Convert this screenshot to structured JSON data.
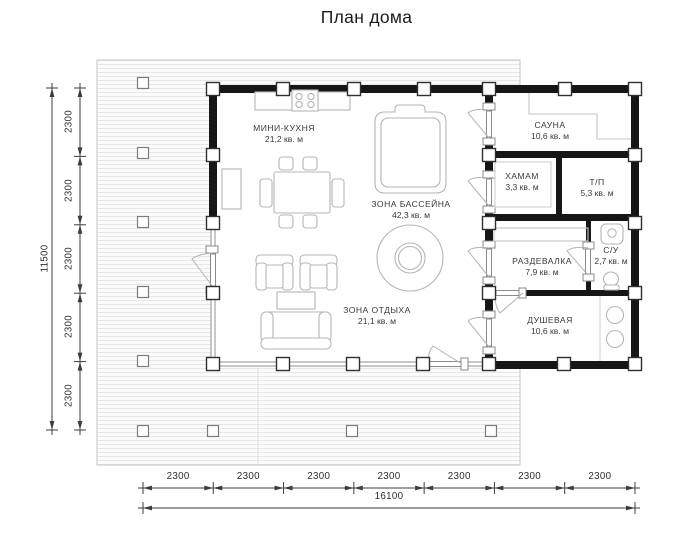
{
  "title": "План дома",
  "rooms": {
    "kitchen": {
      "name": "МИНИ-КУХНЯ",
      "area": "21,2 кв. м"
    },
    "pool": {
      "name": "ЗОНА БАССЕЙНА",
      "area": "42,3 кв. м"
    },
    "rest": {
      "name": "ЗОНА ОТДЫХА",
      "area": "21,1 кв. м"
    },
    "sauna": {
      "name": "САУНА",
      "area": "10,6 кв. м"
    },
    "hamam": {
      "name": "ХАМАМ",
      "area": "3,3 кв. м"
    },
    "tp": {
      "name": "Т/П",
      "area": "5,3 кв. м"
    },
    "razdevalka": {
      "name": "РАЗДЕВАЛКА",
      "area": "7,9 кв. м"
    },
    "su": {
      "name": "С/У",
      "area": "2,7 кв. м"
    },
    "dushevaya": {
      "name": "ДУШЕВАЯ",
      "area": "10,6 кв. м"
    }
  },
  "dimensions": {
    "vertical": {
      "segments": [
        "2300",
        "2300",
        "2300",
        "2300",
        "2300"
      ],
      "total": "11500"
    },
    "horizontal": {
      "segments": [
        "2300",
        "2300",
        "2300",
        "2300",
        "2300",
        "2300",
        "2300"
      ],
      "total": "16100"
    }
  },
  "colors": {
    "wall": "#161616",
    "furniture_outline": "#b5b5b5",
    "deck_line": "#e7e7e7",
    "dim": "#3d3d3d"
  }
}
